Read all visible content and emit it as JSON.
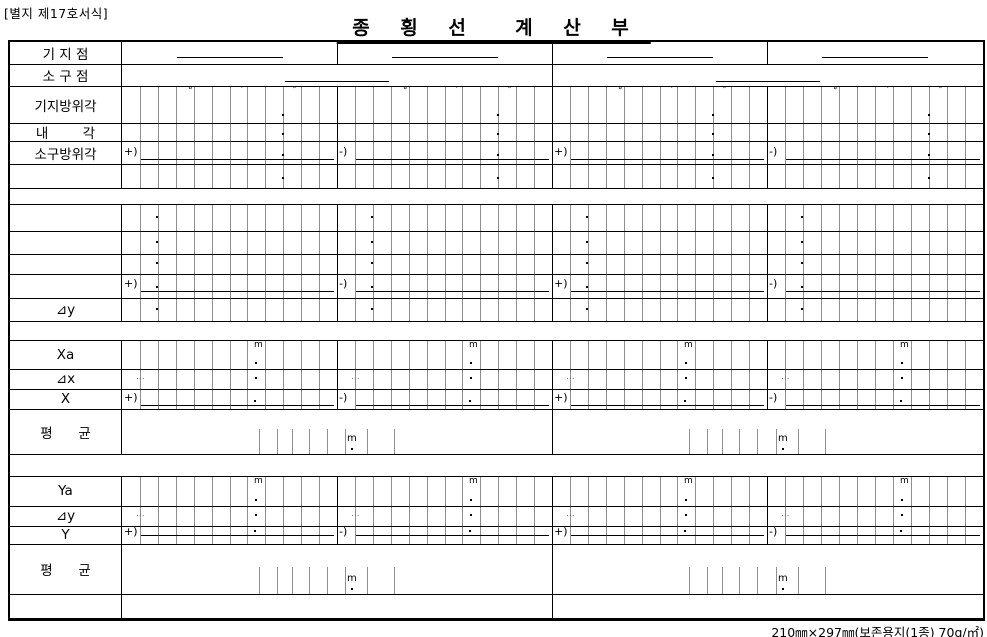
{
  "document": {
    "note": "[별지 제17호서식]",
    "title": "종 횡 선  계 산 부",
    "footer": "210㎜×297㎜(보존용지(1종) 70g/㎡)"
  },
  "symbols": {
    "degree": "°",
    "minute": "′",
    "second": "″",
    "meter": "m",
    "decimal_point": ".",
    "ellipsis": "...",
    "ops": [
      "+)",
      "-)",
      "+)",
      "-)"
    ]
  },
  "table": {
    "rows": [
      {
        "id": "base-point",
        "label": "기 지 점",
        "type": "points4"
      },
      {
        "id": "target-point",
        "label": "소 구 점",
        "type": "points2"
      },
      {
        "id": "base-azimuth",
        "label": "기지방위각",
        "type": "angle_head"
      },
      {
        "id": "interior-angle",
        "label": "내        각",
        "type": "angle"
      },
      {
        "id": "target-azimuth",
        "label": "소구방위각",
        "type": "angle_op"
      },
      {
        "id": "angle-extra",
        "label": "",
        "type": "angle"
      },
      {
        "id": "spacer-1",
        "label": "",
        "type": "spacer"
      },
      {
        "id": "calc-row-1",
        "label": "",
        "type": "mid"
      },
      {
        "id": "calc-row-2",
        "label": "",
        "type": "mid"
      },
      {
        "id": "calc-row-3",
        "label": "",
        "type": "mid"
      },
      {
        "id": "calc-sum",
        "label": "",
        "type": "mid_op"
      },
      {
        "id": "delta-y-upper",
        "label": "⊿y",
        "type": "mid"
      },
      {
        "id": "spacer-2",
        "label": "",
        "type": "spacer"
      },
      {
        "id": "xa",
        "label": "Xa",
        "type": "coord_m"
      },
      {
        "id": "delta-x",
        "label": "⊿x",
        "type": "coord_dots"
      },
      {
        "id": "x",
        "label": "X",
        "type": "coord_op_bottom"
      },
      {
        "id": "mean-x",
        "label": "평      균",
        "type": "mean"
      },
      {
        "id": "spacer-3",
        "label": "",
        "type": "spacer"
      },
      {
        "id": "ya",
        "label": "Ya",
        "type": "coord_m"
      },
      {
        "id": "delta-y",
        "label": "⊿y",
        "type": "coord_dots"
      },
      {
        "id": "y",
        "label": "Y",
        "type": "coord_op_middle"
      },
      {
        "id": "mean-y",
        "label": "평      균",
        "type": "mean"
      },
      {
        "id": "bottom-blank",
        "label": "",
        "type": "blank_end"
      }
    ]
  }
}
